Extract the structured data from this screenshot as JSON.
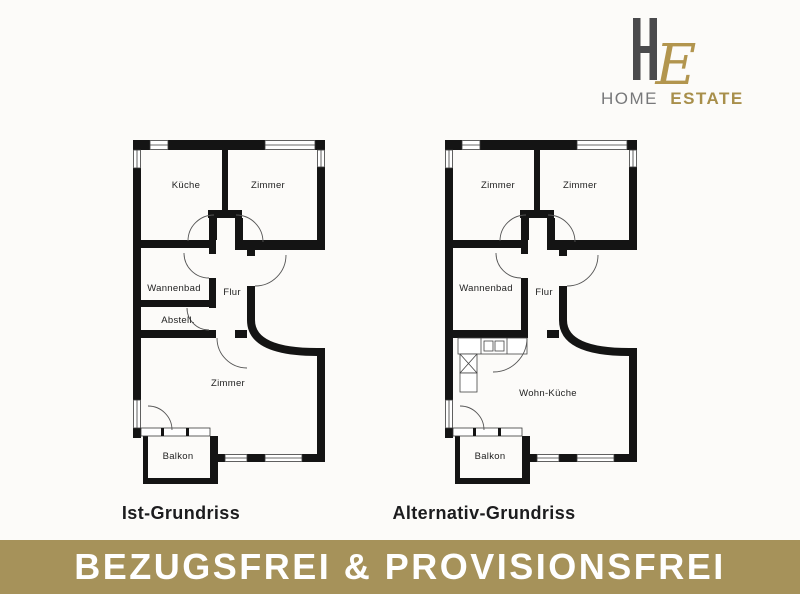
{
  "logo": {
    "monogram_h": "H",
    "monogram_e": "E",
    "name_part1": "HOME",
    "name_part2": "ESTATE"
  },
  "plans": {
    "left": {
      "caption": "Ist-Grundriss",
      "rooms": {
        "top_left": "Küche",
        "top_right": "Zimmer",
        "bath": "Wannenbad",
        "hall": "Flur",
        "storage": "Abstell.",
        "main": "Zimmer",
        "balcony": "Balkon"
      }
    },
    "right": {
      "caption": "Alternativ-Grundriss",
      "rooms": {
        "top_left": "Zimmer",
        "top_right": "Zimmer",
        "bath": "Wannenbad",
        "hall": "Flur",
        "main": "Wohn-Küche",
        "balcony": "Balkon"
      }
    }
  },
  "banner": {
    "text": "BEZUGSFREI & PROVISIONSFREI",
    "background_color": "#a6925a",
    "text_color": "#ffffff"
  },
  "colors": {
    "wall": "#141414",
    "thin_line": "#3a3a3a",
    "door_arc": "#555555",
    "logo_h_gray": "#4a4a4c",
    "logo_gold": "#a88f4b",
    "logo_script_gold": "#b2954e",
    "logo_name_gray": "#77787a",
    "page_background": "#fcfbf9"
  }
}
